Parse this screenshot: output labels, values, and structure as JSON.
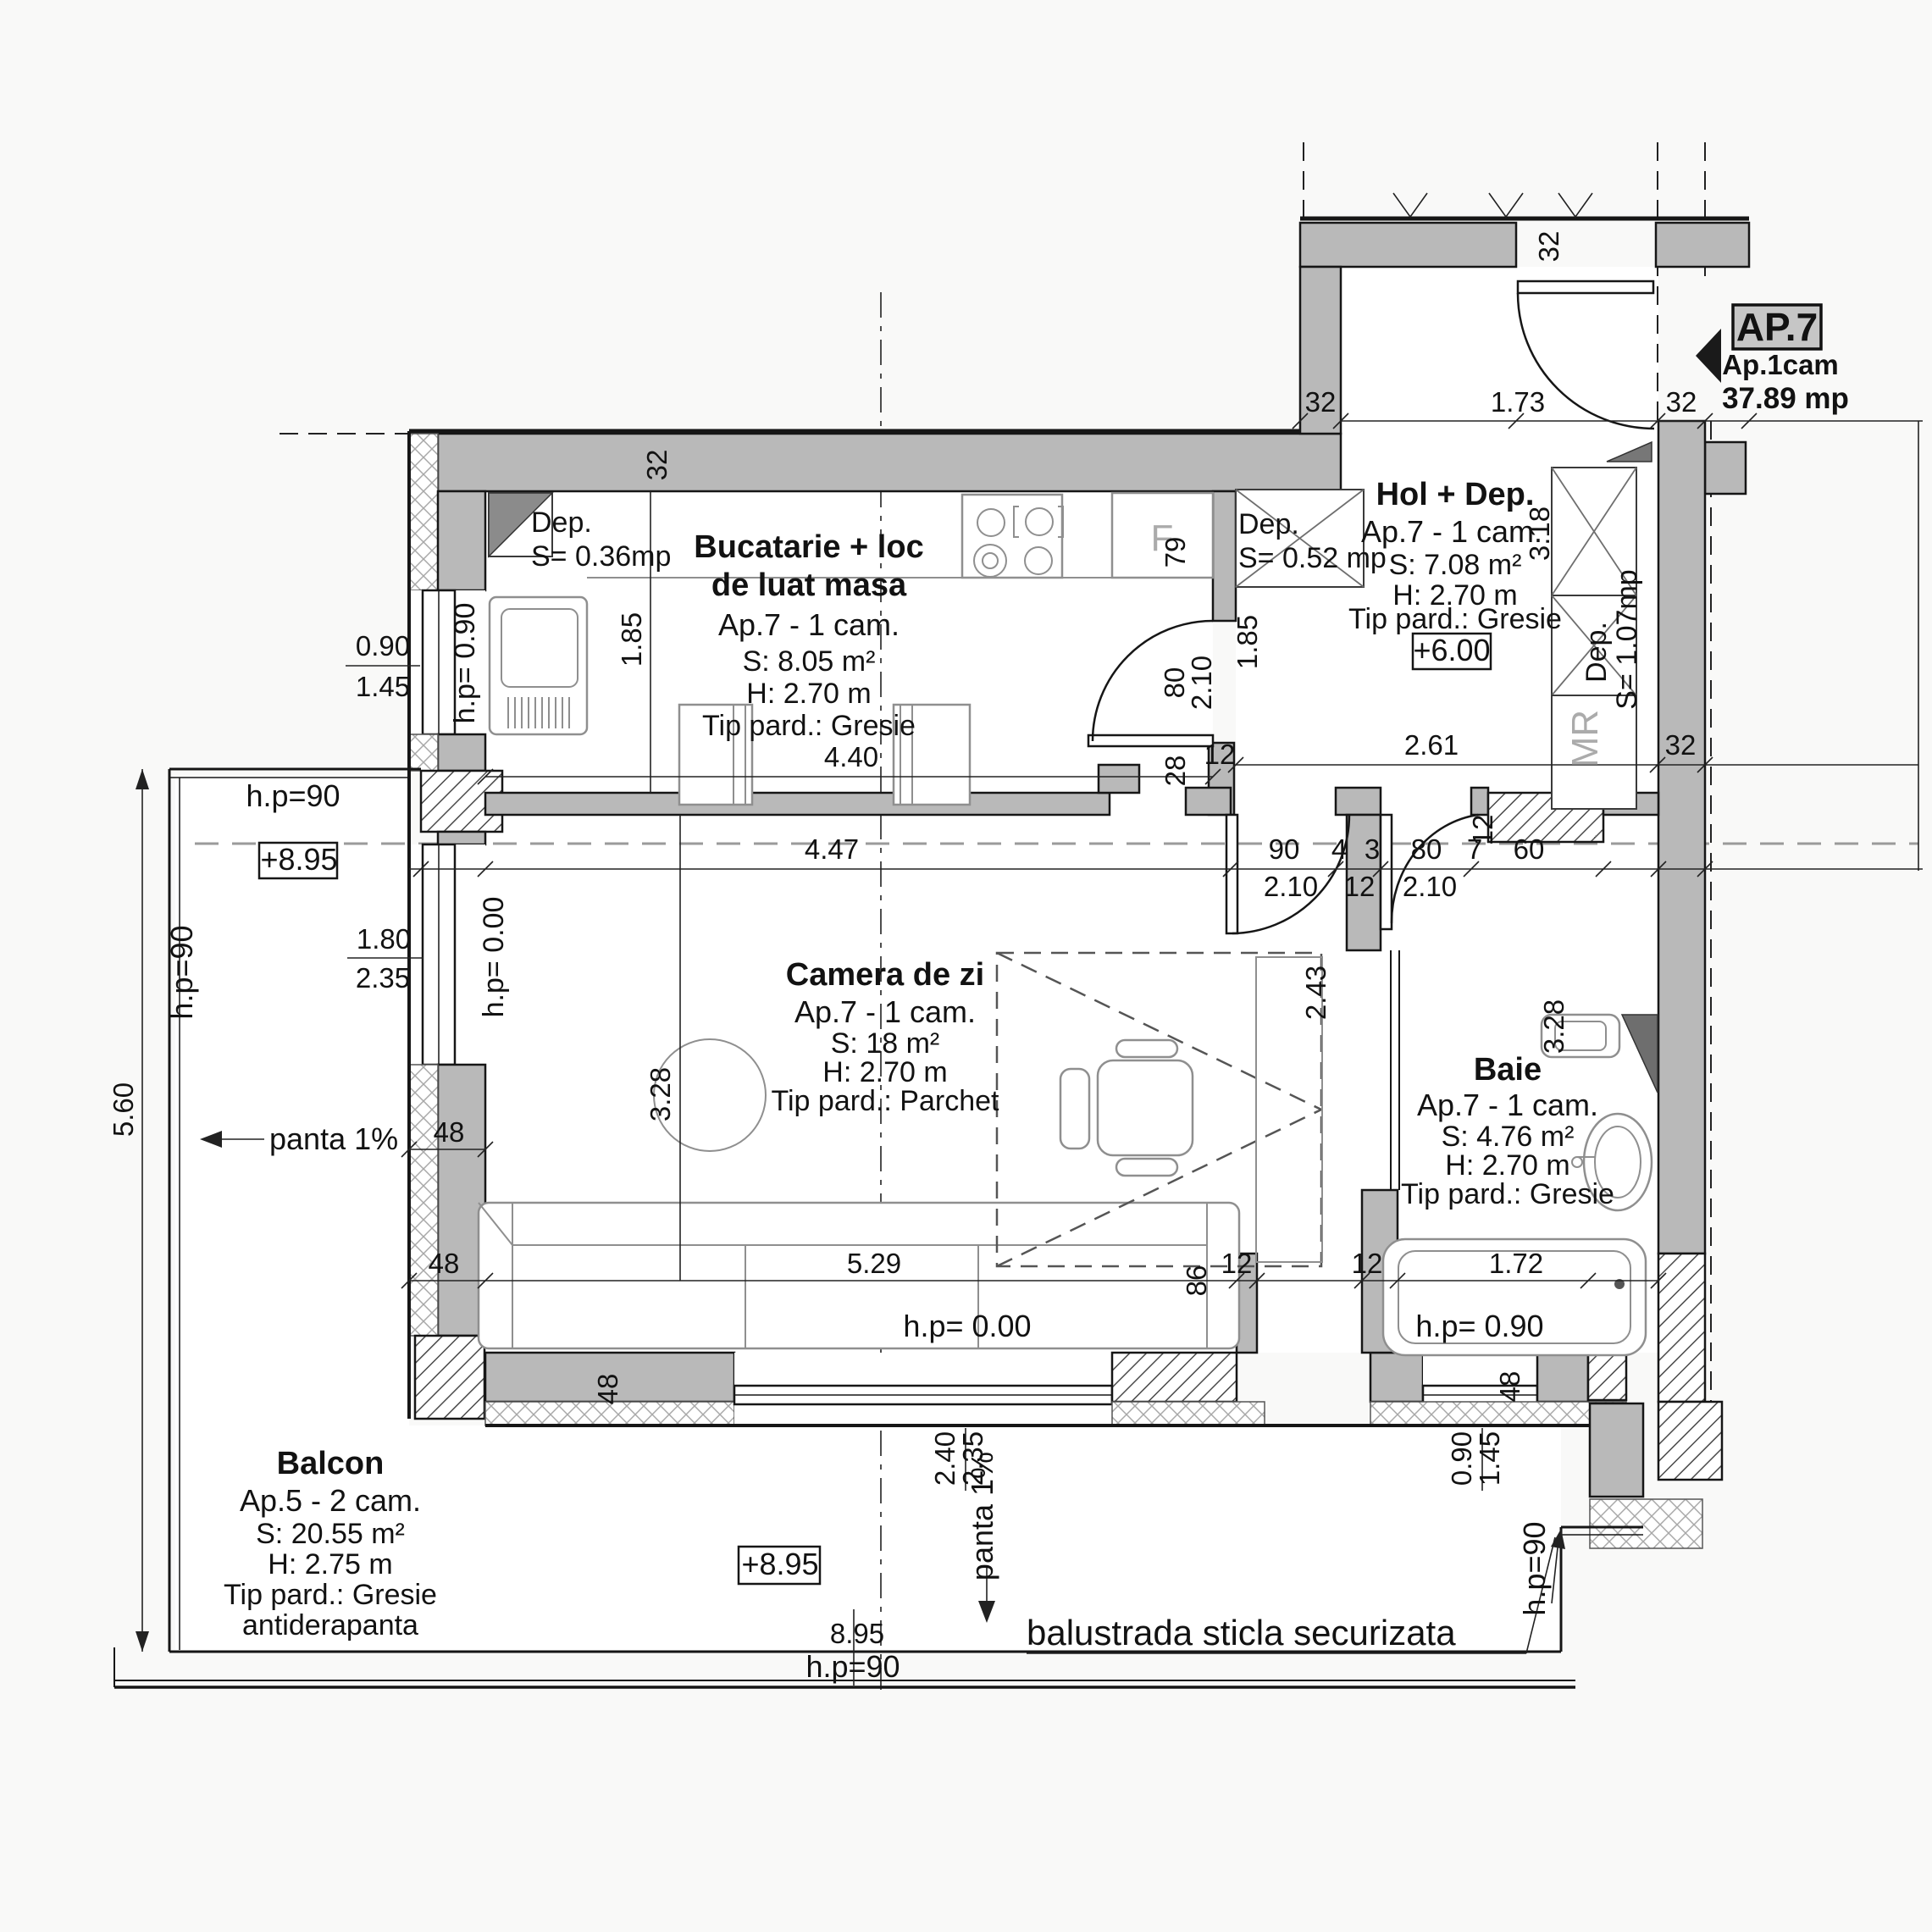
{
  "marker": {
    "code": "AP.7",
    "unit": "Ap.1cam",
    "area": "37.89 mp"
  },
  "rooms": {
    "kitchen": {
      "name1": "Bucatarie + loc",
      "name2": "de luat masa",
      "apt": "Ap.7 - 1 cam.",
      "area": "S: 8.05 m²",
      "height": "H: 2.70 m",
      "floor": "Tip pard.: Gresie"
    },
    "hol": {
      "name": "Hol + Dep.",
      "apt": "Ap.7 - 1 cam.",
      "area": "S: 7.08 m²",
      "height": "H: 2.70 m",
      "floor": "Tip pard.: Gresie",
      "level": "+6.00"
    },
    "living": {
      "name": "Camera de zi",
      "apt": "Ap.7 - 1 cam.",
      "area": "S: 18 m²",
      "height": "H: 2.70 m",
      "floor": "Tip pard.: Parchet"
    },
    "bath": {
      "name": "Baie",
      "apt": "Ap.7 - 1 cam.",
      "area": "S: 4.76 m²",
      "height": "H: 2.70 m",
      "floor": "Tip pard.: Gresie"
    },
    "balcony": {
      "name": "Balcon",
      "apt": "Ap.5 - 2 cam.",
      "area": "S: 20.55 m²",
      "height": "H: 2.75 m",
      "floor": "Tip pard.: Gresie",
      "floor2": "antiderapanta"
    }
  },
  "storage": {
    "dep1_name": "Dep.",
    "dep1_area": "S= 0.36mp",
    "dep2_name": "Dep.",
    "dep2_area": "S= 0.52 mp",
    "dep3_name": "Dep.",
    "dep3_area": "S= 1.07mp",
    "mr": "MR",
    "fridge": "F"
  },
  "levels": {
    "balcony_top": "+8.95",
    "balcony_bottom": "+8.95"
  },
  "annotations": {
    "hp90_balcony_top": "h.p=90",
    "hp90_left": "h.p=90",
    "hp90_bottom": "h.p=90",
    "hp90_right": "h.p=90",
    "hp_090_kitchen": "h.p= 0.90",
    "hp_090_bath": "h.p= 0.90",
    "hp_000_living_window": "h.p= 0.00",
    "hp_000_living": "h.p= 0.00",
    "panta_left": "panta 1%",
    "panta_bottom": "panta 1%",
    "balustrade": "balustrada sticla securizata"
  },
  "dims": {
    "t32l": "32",
    "t173": "1.73",
    "t32r": "32",
    "ent32": "32",
    "k32": "32",
    "kw090": "0.90",
    "kw145": "1.45",
    "k185": "1.85",
    "k440": "4.40",
    "k79": "79",
    "k80": "80",
    "k210": "2.10",
    "k28": "28",
    "k12": "12",
    "h185": "1.85",
    "h318": "3.18",
    "h261": "2.61",
    "h32": "32",
    "m447": "4.47",
    "m90": "90",
    "m210a": "2.10",
    "m4": "4",
    "m12a": "12",
    "m3": "3",
    "m80": "80",
    "m210b": "2.10",
    "m7": "7",
    "m60": "60",
    "m12b": "12",
    "lw180": "1.80",
    "lw235": "2.35",
    "l328": "3.28",
    "l243": "2.43",
    "l529": "5.29",
    "l48a": "48",
    "l48b": "48",
    "l48c": "48",
    "l86": "86",
    "l12a": "12",
    "l12b": "12",
    "l240": "2.40",
    "l235": "2.35",
    "b328": "3.28",
    "b172": "1.72",
    "b48": "48",
    "bw090": "0.90",
    "bw145": "1.45",
    "v560": "5.60",
    "bot895": "8.95"
  }
}
